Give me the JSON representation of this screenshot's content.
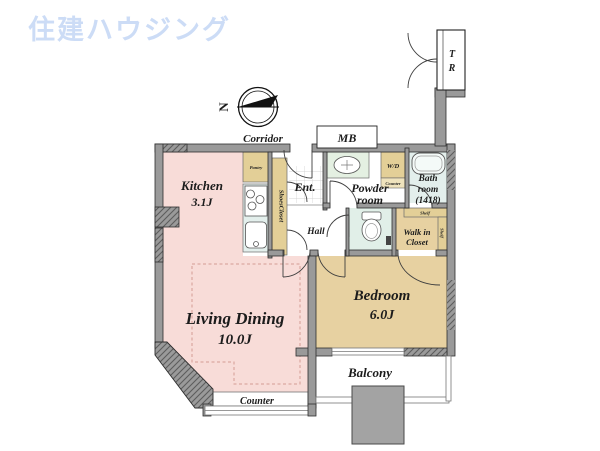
{
  "brand": {
    "logo_text": "住建ハウジング"
  },
  "compass": {
    "north_label": "N"
  },
  "exterior": {
    "corridor": "Corridor",
    "meter_box": "MB",
    "trunk_room": {
      "letter1": "T",
      "letter2": "R"
    },
    "balcony": "Balcony"
  },
  "rooms": {
    "kitchen": {
      "name": "Kitchen",
      "size": "3.1J"
    },
    "living_dining": {
      "name": "Living Dining",
      "size": "10.0J"
    },
    "bedroom": {
      "name": "Bedroom",
      "size": "6.0J"
    },
    "entrance": {
      "name": "Ent."
    },
    "hall": {
      "name": "Hall"
    },
    "powder_room": {
      "line1": "Powder",
      "line2": "room"
    },
    "bath_room": {
      "line1": "Bath",
      "line2": "room",
      "line3": "(1418)"
    },
    "walk_in_closet": {
      "line1": "Walk in",
      "line2": "Closet",
      "shelf_top": "Shelf",
      "shelf_right": "Shelf"
    }
  },
  "fixtures": {
    "pantry": "Pantry",
    "shoes_closet": "ShoesCloset",
    "washer_dryer": "W/D",
    "wd_counter": "Counter",
    "ld_counter": "Counter"
  },
  "colors": {
    "logo_blue": "#ccdcf6",
    "wall": "#9a9a9a",
    "pink": "#f8dcd8",
    "tan": "#e7d1a1",
    "cabinet": "#e3cf97",
    "bath": "#e3efec",
    "toilet": "#e1efe8",
    "pgreen": "#e4f0e2"
  }
}
